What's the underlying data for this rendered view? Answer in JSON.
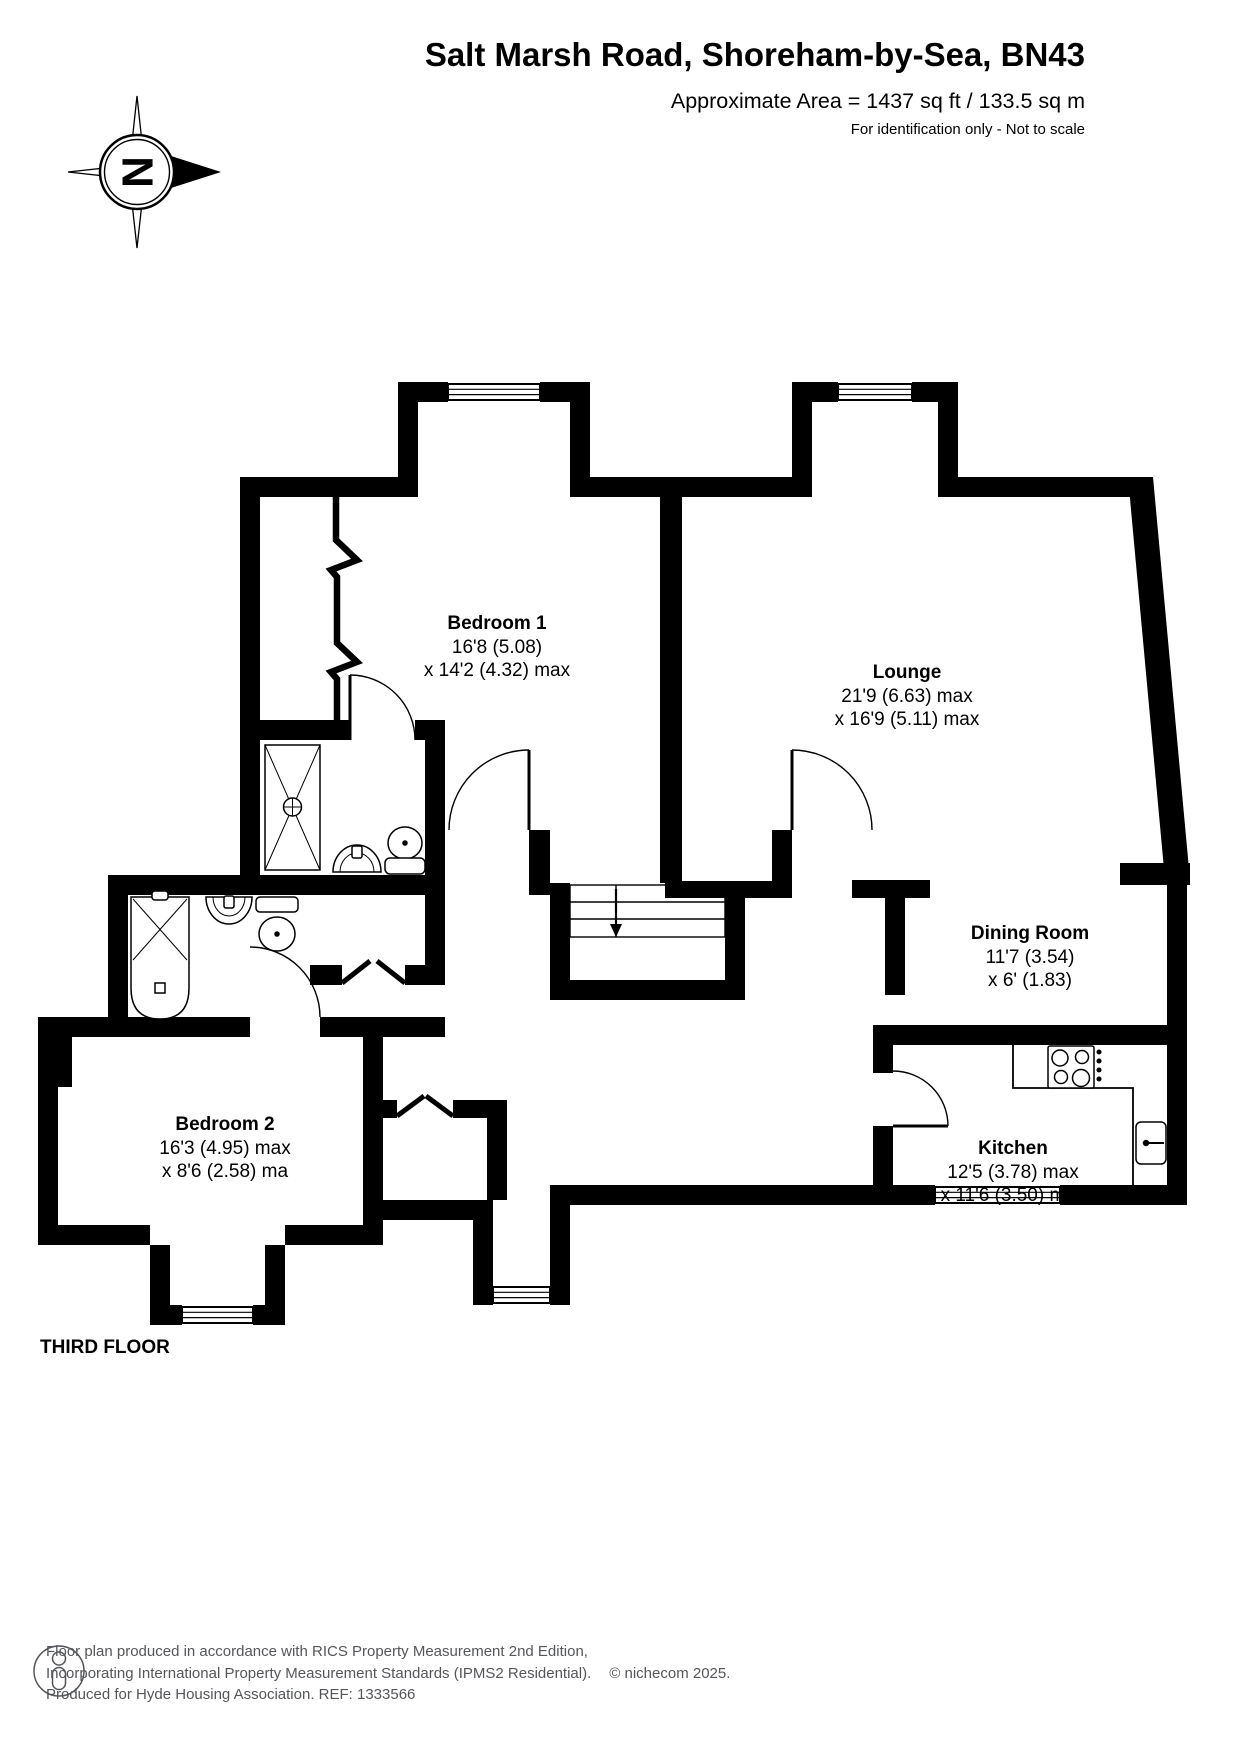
{
  "header": {
    "title": "Salt Marsh Road, Shoreham-by-Sea, BN43",
    "area_line": "Approximate Area = 1437 sq ft / 133.5 sq m",
    "disclaimer": "For identification only - Not to scale"
  },
  "compass": {
    "north_label": "N"
  },
  "floor_label": "THIRD FLOOR",
  "rooms": [
    {
      "name": "Bedroom 1",
      "dim1": "16'8 (5.08)",
      "dim2": "x 14'2 (4.32) max"
    },
    {
      "name": "Lounge",
      "dim1": "21'9 (6.63) max",
      "dim2": "x 16'9 (5.11)  max"
    },
    {
      "name": "Dining Room",
      "dim1": "11'7 (3.54)",
      "dim2": "x 6' (1.83)"
    },
    {
      "name": "Bedroom 2",
      "dim1": "16'3 (4.95) max",
      "dim2": "x 8'6 (2.58) ma"
    },
    {
      "name": "Kitchen",
      "dim1": "12'5 (3.78) max",
      "dim2": "x 11'6 (3.50)  max"
    }
  ],
  "footer": {
    "line1": "Floor plan produced in accordance with RICS Property Measurement 2nd Edition,",
    "line2": "Incorporating International Property Measurement Standards (IPMS2 Residential).",
    "copyright": "© nichecom 2025.",
    "line3": "Produced for Hyde Housing Association.  REF: 1333566"
  },
  "colors": {
    "wall": "#000000",
    "footer_text": "#55565a"
  }
}
